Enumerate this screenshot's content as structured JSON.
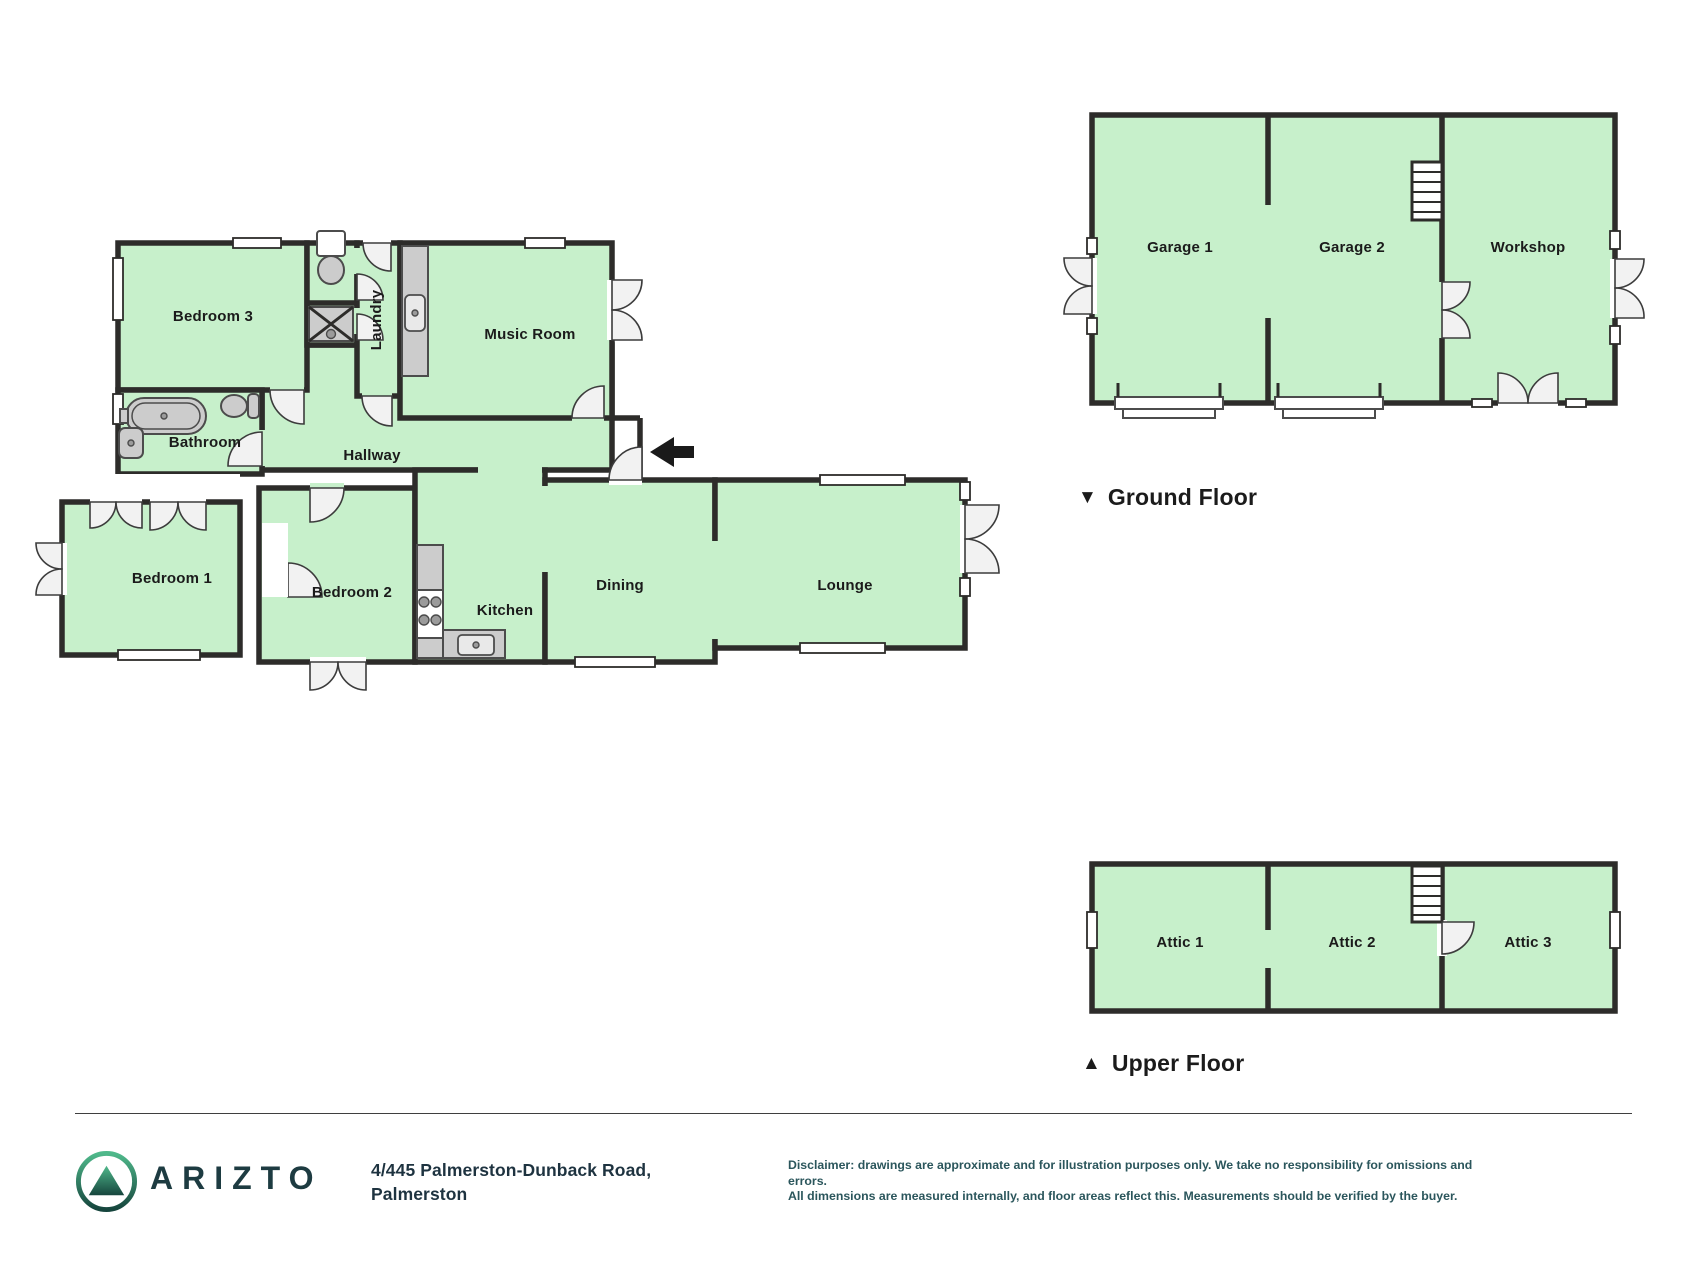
{
  "colors": {
    "room_fill": "#c7f0cb",
    "wall": "#2d2c2a",
    "door_leaf": "#f2f2f2",
    "fixture": "#cccccc",
    "brand_teal": "#1d3b41",
    "address_text": "#1e3340",
    "disclaimer_text": "#2b565c",
    "label_text": "#1b1b1b",
    "logo_green_light": "#4fb98b",
    "logo_green_dark": "#16453d"
  },
  "rooms": {
    "bedroom3": "Bedroom 3",
    "laundry": "Laundry",
    "music_room": "Music Room",
    "bathroom": "Bathroom",
    "hallway": "Hallway",
    "bedroom1": "Bedroom 1",
    "bedroom2": "Bedroom 2",
    "kitchen": "Kitchen",
    "dining": "Dining",
    "lounge": "Lounge",
    "garage1": "Garage 1",
    "garage2": "Garage 2",
    "workshop": "Workshop",
    "attic1": "Attic 1",
    "attic2": "Attic 2",
    "attic3": "Attic 3"
  },
  "ground_floor": {
    "marker": "▼",
    "label": "Ground Floor"
  },
  "upper_floor": {
    "marker": "▲",
    "label": "Upper Floor"
  },
  "footer": {
    "brand": "ARIZTO",
    "address_line1": "4/445 Palmerston-Dunback Road,",
    "address_line2": "Palmerston",
    "disclaimer_line1": "Disclaimer: drawings are approximate and for illustration purposes only. We take no responsibility for omissions and errors.",
    "disclaimer_line2": "All dimensions are measured internally, and floor areas reflect this. Measurements should be verified by the buyer."
  }
}
